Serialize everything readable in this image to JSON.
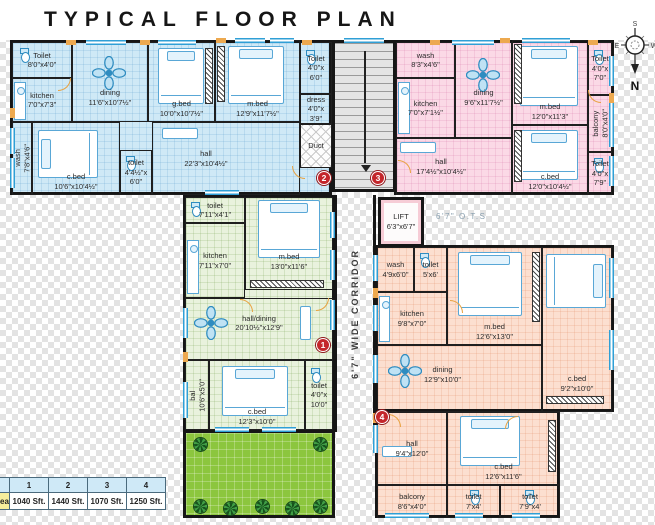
{
  "title": "TYPICAL FLOOR PLAN",
  "compass": {
    "n": "N",
    "s": "S",
    "e": "E",
    "w": "W"
  },
  "core": {
    "corridor": "6'7\" WIDE CORRIDOR",
    "ots": "6'7\"  O.T.S",
    "lift_name": "LIFT",
    "lift_dims": "6'3\"x6'7\"",
    "duct": "Duct",
    "stair_toilet": {
      "name": "Toilet",
      "dims": "4'0\"x 6'0\""
    },
    "dress": {
      "name": "dress",
      "dims": "4'0\"x 3'9\""
    }
  },
  "markers": {
    "m1": "1",
    "m2": "2",
    "m3": "3",
    "m4": "4"
  },
  "flat2": {
    "toilet1": {
      "name": "Toilet",
      "dims": "8'0\"x4'0\""
    },
    "kitchen": {
      "name": "kitchen",
      "dims": "7'0\"x7'3\""
    },
    "dining": {
      "name": "dining",
      "dims": "11'6\"x10'7½\""
    },
    "gbed": {
      "name": "g.bed",
      "dims": "10'0\"x10'7½\""
    },
    "mbed": {
      "name": "m.bed",
      "dims": "12'9\"x11'7½\""
    },
    "wash": {
      "name": "wash",
      "dims": "7'8\"x4'6\""
    },
    "cbed": {
      "name": "c.bed",
      "dims": "10'6\"x10'4½\""
    },
    "toilet2": {
      "name": "toilet",
      "dims": "4'4½\"x 6'0\""
    },
    "hall": {
      "name": "hall",
      "dims": "22'3\"x10'4½\""
    }
  },
  "flat1": {
    "wash": {
      "name": "wash",
      "dims": "8'3\"x4'6\""
    },
    "kitchen": {
      "name": "kitchen",
      "dims": "7'0\"x7'1½\""
    },
    "dining": {
      "name": "dining",
      "dims": "9'6\"x11'7½\""
    },
    "mbed": {
      "name": "m.bed",
      "dims": "12'0\"x11'3\""
    },
    "toilet_top": {
      "name": "Toilet",
      "dims": "4'0\"x 7'0\""
    },
    "balcony": {
      "name": "balcony",
      "dims": "8'0\"x4'0\""
    },
    "toilet_bottom": {
      "name": "Toilet",
      "dims": "4'0\"x 7'9\""
    },
    "hall": {
      "name": "hall",
      "dims": "17'4½\"x10'4½\""
    },
    "cbed": {
      "name": "c.bed",
      "dims": "12'0\"x10'4½\""
    }
  },
  "flat3": {
    "toilet1": {
      "name": "toilet",
      "dims": "7'11\"x4'1\""
    },
    "kitchen": {
      "name": "kitchen",
      "dims": "7'11\"x7'0\""
    },
    "mbed": {
      "name": "m.bed",
      "dims": "13'0\"x11'6\""
    },
    "halldining": {
      "name": "hall/dining",
      "dims": "20'10½\"x12'9\""
    },
    "bal": {
      "name": "bal",
      "dims": "10'6\"x5'0\""
    },
    "cbed": {
      "name": "c.bed",
      "dims": "12'3\"x10'0\""
    },
    "toilet2": {
      "name": "toilet",
      "dims": "4'0\"x 10'0\""
    }
  },
  "flat4": {
    "wash": {
      "name": "wash",
      "dims": "4'9x6'0\""
    },
    "toilet1": {
      "name": "toilet",
      "dims": "5'x6'"
    },
    "kitchen": {
      "name": "kitchen",
      "dims": "9'8\"x7'0\""
    },
    "mbed": {
      "name": "m.bed",
      "dims": "12'6\"x13'0\""
    },
    "dining": {
      "name": "dining",
      "dims": "12'9\"x10'0\""
    },
    "cbed1": {
      "name": "c.bed",
      "dims": "9'2\"x10'0\""
    },
    "hall": {
      "name": "hall",
      "dims": "9'4\"x12'0\""
    },
    "cbed2": {
      "name": "c.bed",
      "dims": "12'6\"x11'6\""
    },
    "balcony": {
      "name": "balcony",
      "dims": "8'6\"x4'0\""
    },
    "toilet2": {
      "name": "toilet",
      "dims": "7'x4'"
    },
    "toilet3": {
      "name": "toilet",
      "dims": "7'9\"x4'"
    }
  },
  "area_table": {
    "label_fragment": "ea",
    "row1": [
      "1",
      "2",
      "3",
      "4"
    ],
    "row2": [
      "1040 Sft.",
      "1440 Sft.",
      "1070 Sft.",
      "1250 Sft."
    ]
  }
}
